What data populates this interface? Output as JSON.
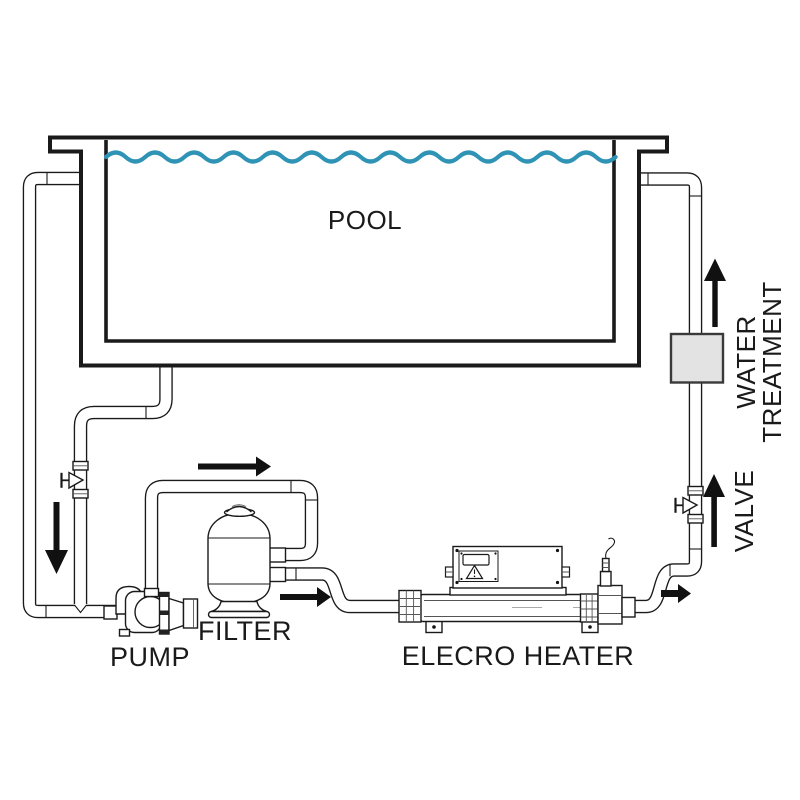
{
  "labels": {
    "pool": "POOL",
    "pump": "PUMP",
    "filter": "FILTER",
    "heater": "ELECRO HEATER",
    "valve": "VALVE",
    "water_treatment_line1": "WATER",
    "water_treatment_line2": "TREATMENT"
  },
  "colors": {
    "line": "#1a1a1a",
    "water": "#2E93B5",
    "treatment_box_fill": "#E3E3E3",
    "pipe_fill": "#ffffff",
    "background": "#ffffff",
    "arrow": "#111111"
  },
  "icons": {
    "flow_arrows": [
      "down-arrow",
      "right-arrow",
      "right-arrow",
      "right-arrow",
      "up-arrow",
      "up-arrow"
    ],
    "valve_symbol": "triangle-with-stem",
    "warning_symbol": "warning-triangle"
  }
}
